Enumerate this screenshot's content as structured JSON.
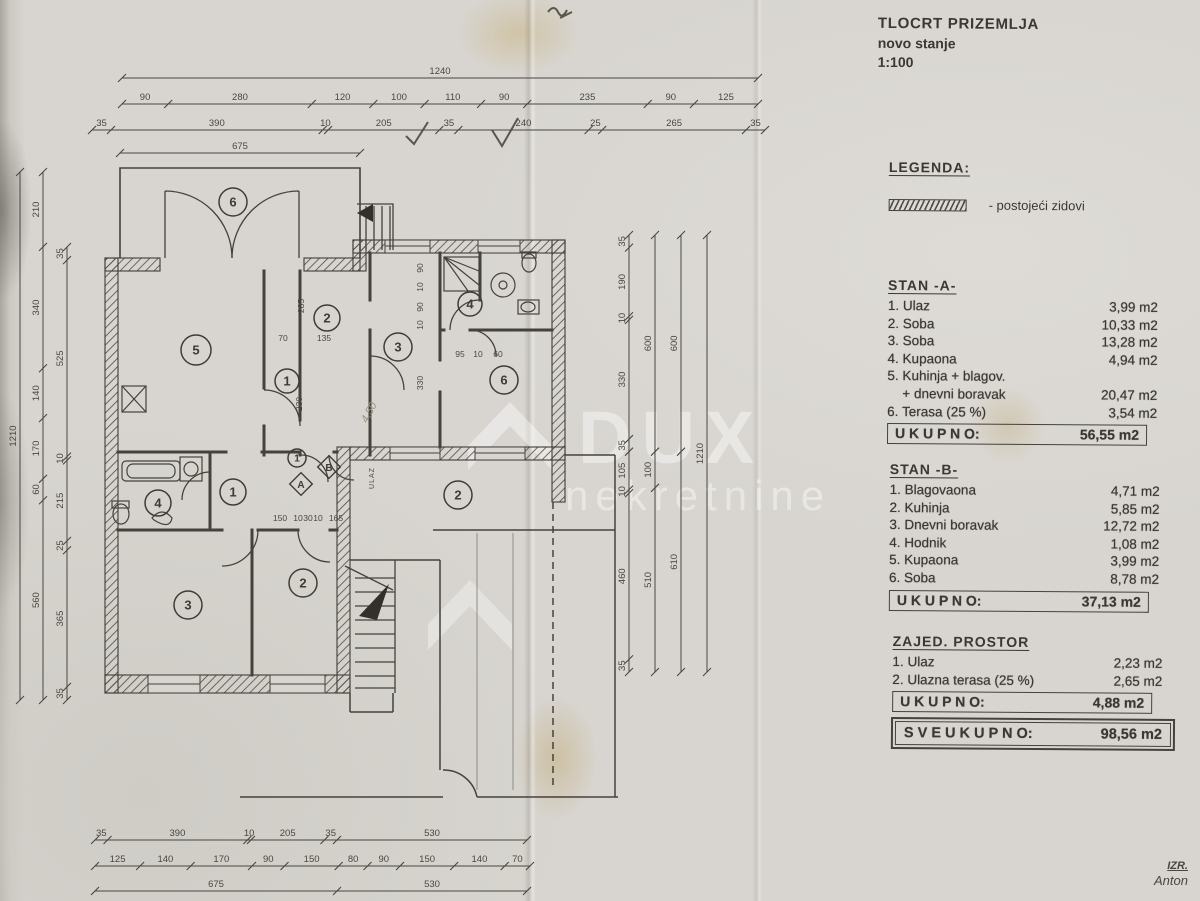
{
  "header": {
    "title": "TLOCRT PRIZEMLJA",
    "subtitle": "novo stanje",
    "scale": "1:100"
  },
  "legend": {
    "heading": "LEGENDA:",
    "wall_label": "- postojeći zidovi"
  },
  "sections": [
    {
      "heading": "STAN  -A-",
      "rows": [
        [
          "1. Ulaz",
          "3,99 m2"
        ],
        [
          "2. Soba",
          "10,33 m2"
        ],
        [
          "3. Soba",
          "13,28 m2"
        ],
        [
          "4. Kupaona",
          "4,94 m2"
        ],
        [
          "5. Kuhinja + blagov.",
          ""
        ],
        [
          "    + dnevni boravak",
          "20,47 m2"
        ],
        [
          "6. Terasa (25 %)",
          "3,54 m2"
        ]
      ],
      "total_label": "U K U P N O:",
      "total_value": "56,55 m2"
    },
    {
      "heading": "STAN  -B-",
      "rows": [
        [
          "1. Blagovaona",
          "4,71 m2"
        ],
        [
          "2. Kuhinja",
          "5,85 m2"
        ],
        [
          "3. Dnevni boravak",
          "12,72 m2"
        ],
        [
          "4. Hodnik",
          "1,08 m2"
        ],
        [
          "5. Kupaona",
          "3,99 m2"
        ],
        [
          "6. Soba",
          "8,78 m2"
        ]
      ],
      "total_label": "U K U P N O:",
      "total_value": "37,13 m2"
    },
    {
      "heading": "ZAJED. PROSTOR",
      "rows": [
        [
          "1. Ulaz",
          "2,23 m2"
        ],
        [
          "2. Ulazna terasa (25 %)",
          "2,65 m2"
        ]
      ],
      "total_label": "U K U P N O:",
      "total_value": "4,88 m2"
    }
  ],
  "grand_total": {
    "label": "S V E U K U P N O:",
    "value": "98,56 m2"
  },
  "signature": {
    "line1": "IZR.",
    "line2": "Anton"
  },
  "watermark": {
    "line1": "DUX",
    "line2": "nekretnine"
  },
  "colors": {
    "paper": "#d8d5d0",
    "ink": "#45413b",
    "accent_stain": "#bc983c"
  },
  "plan": {
    "dims": {
      "top1": [
        "1240"
      ],
      "top2": [
        "90",
        "280",
        "120",
        "100",
        "110",
        "90",
        "235",
        "90",
        "125"
      ],
      "top3": [
        "35",
        "390",
        "10",
        "205",
        "35",
        "240",
        "25",
        "265",
        "35"
      ],
      "top4": [
        "675"
      ],
      "bot1": [
        "35",
        "390",
        "10",
        "205",
        "35",
        "530"
      ],
      "bot2": [
        "125",
        "140",
        "170",
        "90",
        "150",
        "80",
        "90",
        "150",
        "140",
        "70"
      ],
      "bot3": [
        "675",
        "530"
      ],
      "left1": [
        "1210"
      ],
      "left2": [
        "210",
        "340",
        "140",
        "170",
        "60",
        "560"
      ],
      "left3": [
        "35",
        "525",
        "10",
        "215",
        "25",
        "365",
        "35"
      ],
      "right1": [
        "35",
        "190",
        "10",
        "330",
        "35",
        "105",
        "10",
        "460",
        "35"
      ],
      "right2": [
        "600",
        "100",
        "510"
      ],
      "right3": [
        "600",
        "610"
      ],
      "right4": [
        "1210"
      ]
    },
    "room_circles": [
      {
        "n": "6",
        "x": 233,
        "y": 202,
        "r": 14
      },
      {
        "n": "5",
        "x": 196,
        "y": 350,
        "r": 15
      },
      {
        "n": "1",
        "x": 287,
        "y": 381,
        "r": 12
      },
      {
        "n": "2",
        "x": 327,
        "y": 318,
        "r": 13
      },
      {
        "n": "3",
        "x": 398,
        "y": 347,
        "r": 14
      },
      {
        "n": "4",
        "x": 470,
        "y": 304,
        "r": 12
      },
      {
        "n": "6",
        "x": 504,
        "y": 380,
        "r": 14
      },
      {
        "n": "4",
        "x": 158,
        "y": 503,
        "r": 13
      },
      {
        "n": "1",
        "x": 233,
        "y": 492,
        "r": 13
      },
      {
        "n": "1",
        "x": 297,
        "y": 458,
        "r": 9
      },
      {
        "n": "3",
        "x": 188,
        "y": 605,
        "r": 14
      },
      {
        "n": "2",
        "x": 303,
        "y": 583,
        "r": 14
      },
      {
        "n": "2",
        "x": 458,
        "y": 495,
        "r": 14
      }
    ],
    "markers": [
      {
        "t": "A",
        "x": 301,
        "y": 484
      },
      {
        "t": "B",
        "x": 329,
        "y": 467
      }
    ],
    "inner_dims": [
      {
        "t": "285",
        "x": 304,
        "y": 306,
        "v": true
      },
      {
        "t": "70",
        "x": 283,
        "y": 341
      },
      {
        "t": "135",
        "x": 324,
        "y": 341
      },
      {
        "t": "230",
        "x": 302,
        "y": 404,
        "v": true
      },
      {
        "t": "90",
        "x": 423,
        "y": 268,
        "v": true
      },
      {
        "t": "10",
        "x": 423,
        "y": 287,
        "v": true
      },
      {
        "t": "90",
        "x": 423,
        "y": 307,
        "v": true
      },
      {
        "t": "10",
        "x": 423,
        "y": 325,
        "v": true
      },
      {
        "t": "330",
        "x": 423,
        "y": 383,
        "v": true
      },
      {
        "t": "95",
        "x": 460,
        "y": 357
      },
      {
        "t": "10",
        "x": 478,
        "y": 357
      },
      {
        "t": "60",
        "x": 498,
        "y": 357
      },
      {
        "t": "150",
        "x": 280,
        "y": 521
      },
      {
        "t": "10",
        "x": 298,
        "y": 521
      },
      {
        "t": "30",
        "x": 308,
        "y": 521
      },
      {
        "t": "10",
        "x": 318,
        "y": 521
      },
      {
        "t": "165",
        "x": 336,
        "y": 521
      }
    ],
    "ulaz_label": {
      "t": "ULAZ",
      "x": 374,
      "y": 478
    },
    "handwriting_note": {
      "t": "4,50",
      "x": 372,
      "y": 414
    }
  }
}
